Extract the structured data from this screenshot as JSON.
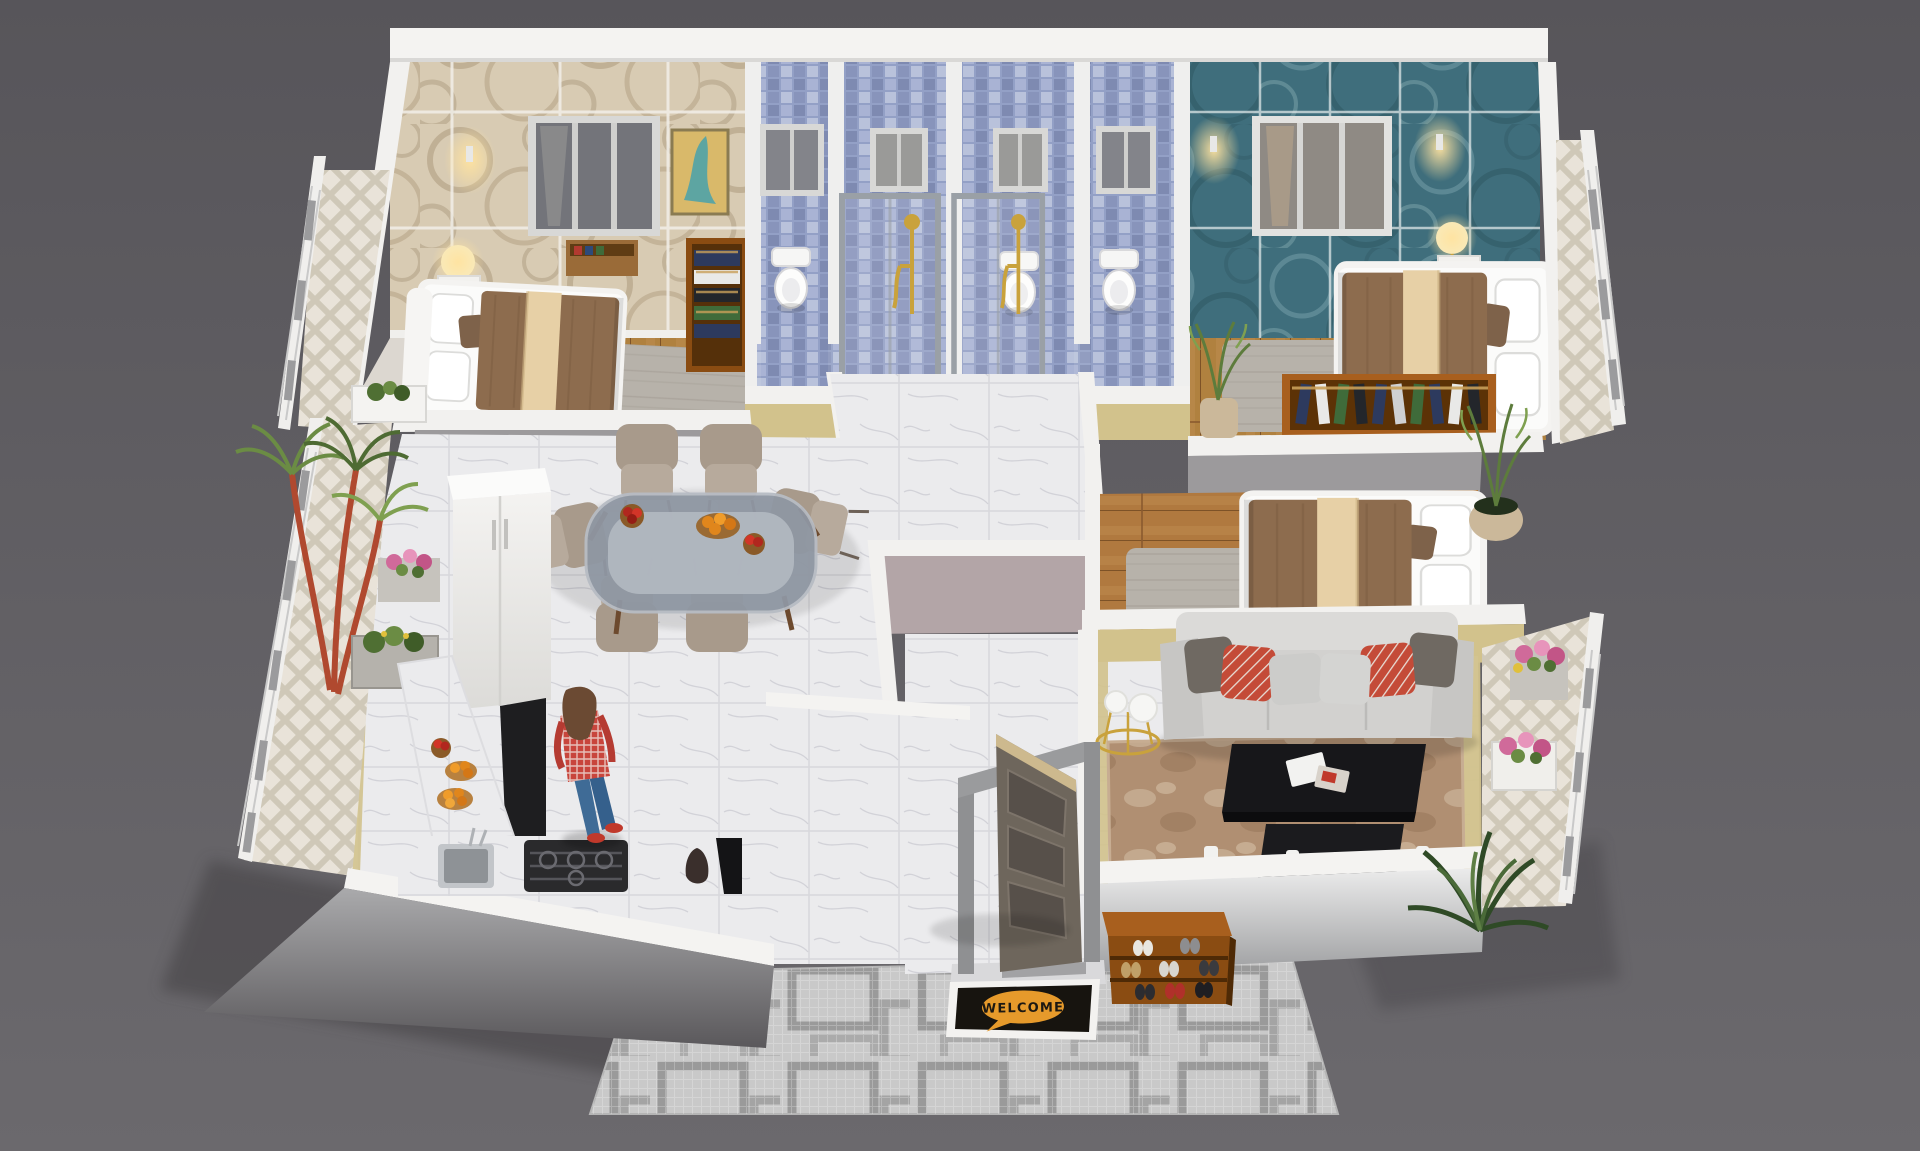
{
  "welcome_mat": {
    "text": "WELCOME",
    "bubble_color": "#e69a2b",
    "mat_color": "#17140f",
    "frame_color": "#f3f2f0"
  },
  "palette": {
    "background": "#59575b",
    "outer_wall": "#f4f3f1",
    "bedroom1_wallpaper": "#d8cbb3",
    "wallpaper_swirl": "#a08b6c",
    "bathroom_tile": "#93a0c6",
    "bedroom2_wallpaper": "#3f6e7c",
    "accent_wall": "#d2c28c",
    "hall_wall": "#b3a5a7",
    "interior_gray_wall": "#9c9a9c",
    "marble_floor": "#ebebed",
    "wood_floor": "#b0813f",
    "balcony_tile": "#e9e3d9",
    "sofa": "#d2d1cf",
    "pillow_red": "#c44b38",
    "pillow_taupe": "#6f6962",
    "living_rug": "#b08f72",
    "coffee_table": "#17171a",
    "bed_quilt": "#8d6c4e",
    "bed_runner": "#e7d0a6",
    "door_wood": "#6e665c",
    "gold_fixture": "#c9a23c",
    "shoe_rack_wood": "#8a4c12",
    "walkway_rug": "#c9c9c9",
    "dining_chair": "#a89a8b",
    "plant_green": "#5d7c3c",
    "flower_pink": "#d06a9a"
  }
}
